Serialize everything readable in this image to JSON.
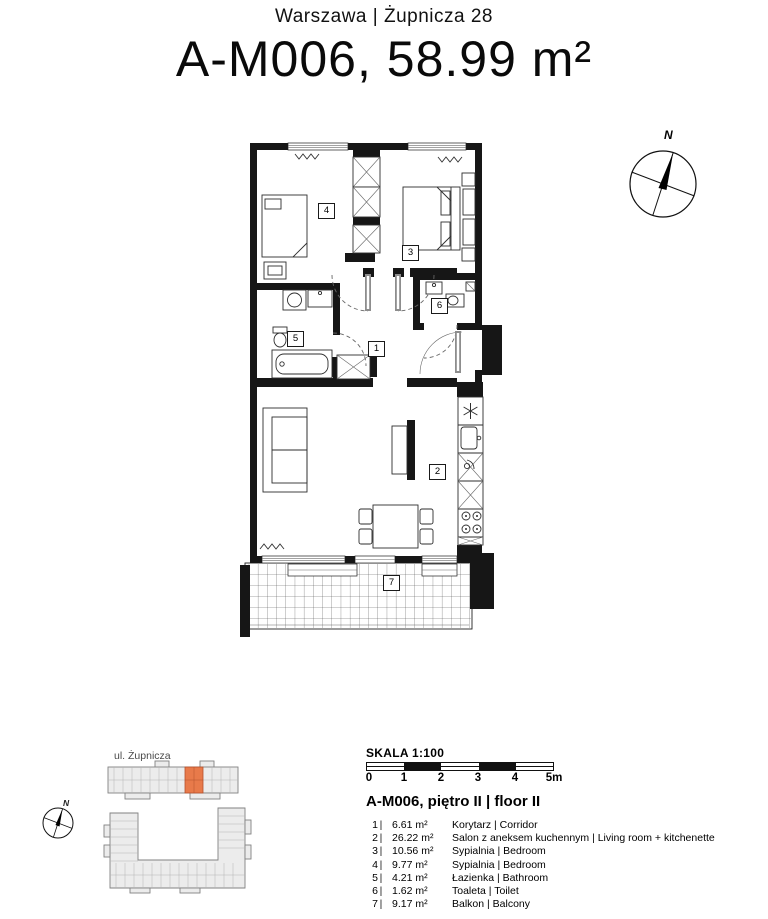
{
  "header": {
    "location": "Warszawa | Żupnicza 28",
    "title": "A-M006, 58.99 m²"
  },
  "compass": {
    "label": "N"
  },
  "site_plan": {
    "street": "ul. Żupnicza",
    "compass_label": "N",
    "highlight_color": "#e87a4a"
  },
  "scale_bar": {
    "label": "SKALA 1:100",
    "ticks": [
      "0",
      "1",
      "2",
      "3",
      "4",
      "5m"
    ]
  },
  "legend": {
    "title": "A-M006, piętro II | floor II",
    "separator": "|"
  },
  "rooms": [
    {
      "num": "1",
      "area": "6.61 m²",
      "name": "Korytarz | Corridor"
    },
    {
      "num": "2",
      "area": "26.22 m²",
      "name": "Salon z aneksem kuchennym | Living room + kitchenette"
    },
    {
      "num": "3",
      "area": "10.56 m²",
      "name": "Sypialnia | Bedroom"
    },
    {
      "num": "4",
      "area": "9.77 m²",
      "name": "Sypialnia | Bedroom"
    },
    {
      "num": "5",
      "area": "4.21 m²",
      "name": "Łazienka | Bathroom"
    },
    {
      "num": "6",
      "area": "1.62 m²",
      "name": "Toaleta | Toilet"
    },
    {
      "num": "7",
      "area": "9.17 m²",
      "name": "Balkon | Balcony"
    }
  ]
}
